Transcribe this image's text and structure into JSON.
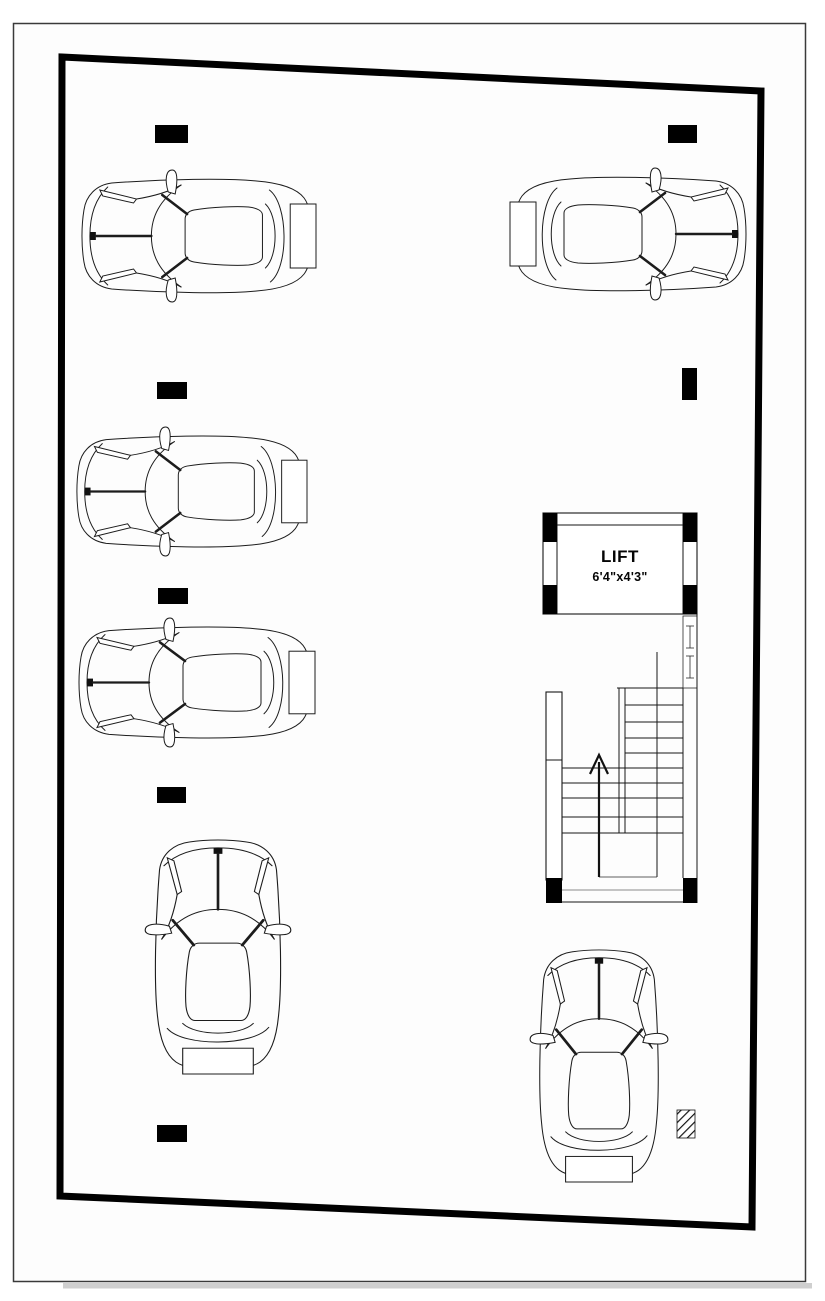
{
  "sheet": {
    "paper_fill": "#fdfdfd",
    "frame_color": "#3a3a3a",
    "shadow_color": "#cfcfcf"
  },
  "colors": {
    "line": "#161616",
    "boundary": "#000000",
    "column_fill": "#000000"
  },
  "lift": {
    "label": "LIFT",
    "dimensions": "6'4\"x4'3\""
  },
  "stair": {
    "direction": "up"
  },
  "boundary": {
    "points": [
      [
        62,
        57
      ],
      [
        761,
        91
      ],
      [
        752,
        1227
      ],
      [
        60,
        1196
      ]
    ],
    "stroke_width": 7
  },
  "structure": {
    "columns": [
      {
        "x": 155,
        "y": 125,
        "w": 33,
        "h": 18
      },
      {
        "x": 668,
        "y": 125,
        "w": 29,
        "h": 18
      },
      {
        "x": 157,
        "y": 382,
        "w": 30,
        "h": 17
      },
      {
        "x": 682,
        "y": 368,
        "w": 15,
        "h": 32
      },
      {
        "x": 158,
        "y": 588,
        "w": 30,
        "h": 16
      },
      {
        "x": 157,
        "y": 787,
        "w": 29,
        "h": 16
      },
      {
        "x": 157,
        "y": 1125,
        "w": 30,
        "h": 17
      },
      {
        "x": 543,
        "y": 513,
        "w": 14,
        "h": 29
      },
      {
        "x": 683,
        "y": 513,
        "w": 14,
        "h": 29
      },
      {
        "x": 543,
        "y": 585,
        "w": 14,
        "h": 29
      },
      {
        "x": 683,
        "y": 585,
        "w": 14,
        "h": 29
      },
      {
        "x": 546,
        "y": 878,
        "w": 16,
        "h": 25
      },
      {
        "x": 683,
        "y": 878,
        "w": 14,
        "h": 25
      }
    ],
    "hatched_column": {
      "x": 677,
      "y": 1110,
      "w": 18,
      "h": 28
    }
  },
  "cars": [
    {
      "id": "car-1",
      "orientation": "horizontal",
      "facing": "left",
      "x": 78,
      "y": 168,
      "w": 238,
      "h": 136
    },
    {
      "id": "car-2",
      "orientation": "horizontal",
      "facing": "right",
      "x": 510,
      "y": 166,
      "w": 240,
      "h": 136
    },
    {
      "id": "car-3",
      "orientation": "horizontal",
      "facing": "left",
      "x": 73,
      "y": 425,
      "w": 234,
      "h": 133
    },
    {
      "id": "car-4",
      "orientation": "horizontal",
      "facing": "left",
      "x": 75,
      "y": 616,
      "w": 240,
      "h": 133
    },
    {
      "id": "car-5",
      "orientation": "vertical",
      "facing": "up",
      "x": 143,
      "y": 836,
      "w": 150,
      "h": 238
    },
    {
      "id": "car-6",
      "orientation": "vertical",
      "facing": "up",
      "x": 528,
      "y": 946,
      "w": 142,
      "h": 236
    }
  ]
}
